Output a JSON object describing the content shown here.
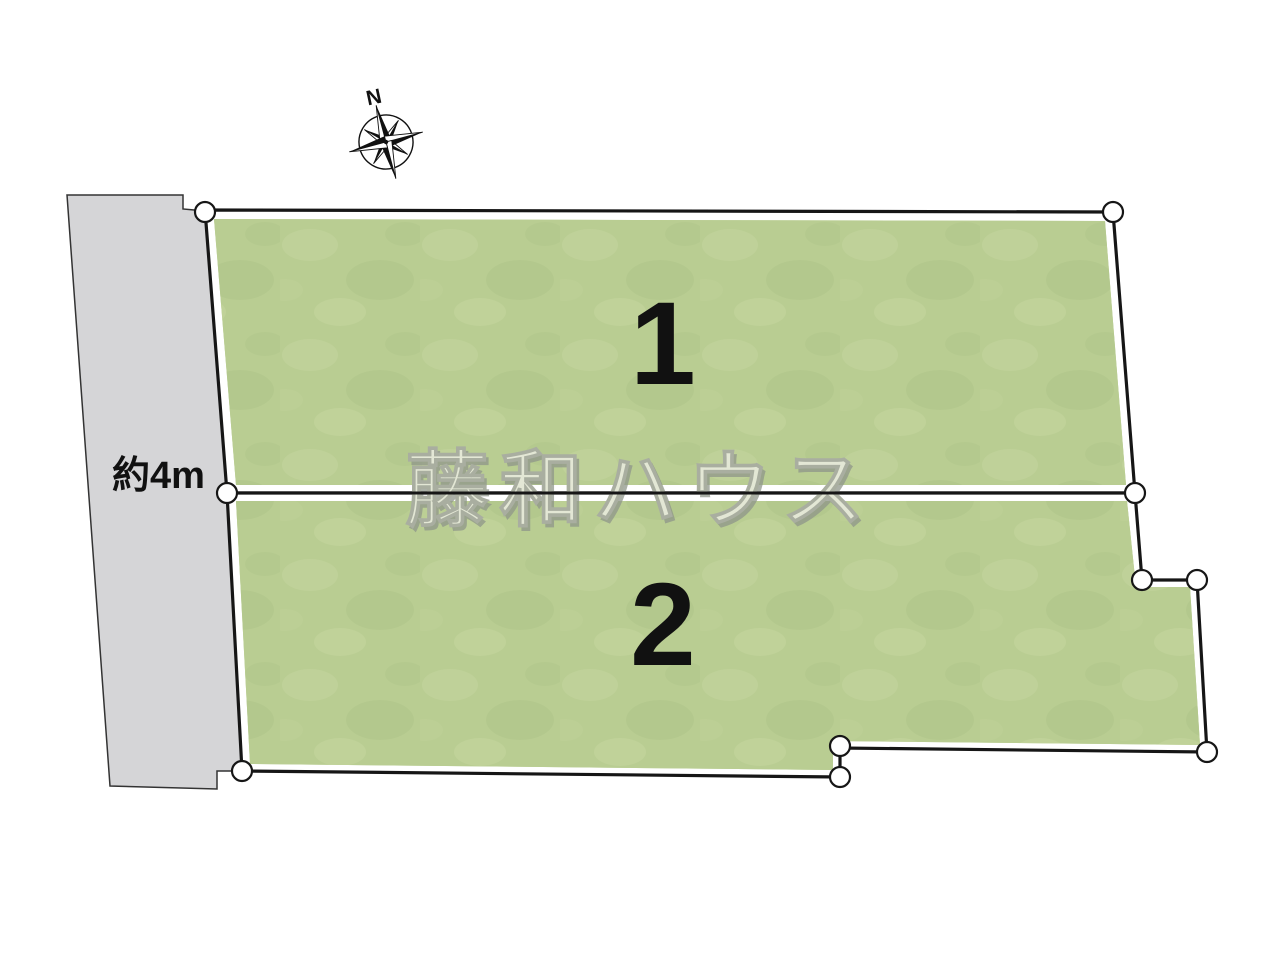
{
  "compass": {
    "label": "N"
  },
  "road": {
    "width_label": "約4m"
  },
  "watermark": {
    "text": "藤和ハウス"
  },
  "plots": [
    {
      "label": "1"
    },
    {
      "label": "2"
    }
  ],
  "diagram": {
    "canvas": {
      "width": 1280,
      "height": 960
    },
    "colors": {
      "plot_fill": "#b9cd92",
      "plot_inset": "#ffffff",
      "outline": "#161616",
      "road_fill": "#d5d5d7",
      "road_stroke": "#333333",
      "vertex_fill": "#ffffff",
      "background": "#ffffff"
    },
    "road": {
      "points": "67,195 183,195 183,209 205,211 227,493 242,771 217,771 217,789 110,786"
    },
    "parcels": [
      {
        "id": "1",
        "outer": "205,210 1113,212 1135,493 227,493",
        "inner": "214,219 1105,221 1126,485 236,485"
      },
      {
        "id": "2",
        "outer": "227,493 1135,493 1142,580 1197,580 1207,752 840,748 840,777 242,771",
        "inner": "236,501 1127,501 1136,587 1190,587 1200,745 833,741 833,770 250,764"
      }
    ],
    "divider": {
      "x1": 227,
      "y1": 493,
      "x2": 1135,
      "y2": 493
    },
    "vertices": [
      [
        205,
        212
      ],
      [
        1113,
        212
      ],
      [
        1135,
        493
      ],
      [
        227,
        493
      ],
      [
        1142,
        580
      ],
      [
        1197,
        580
      ],
      [
        1207,
        752
      ],
      [
        840,
        746
      ],
      [
        840,
        777
      ],
      [
        242,
        771
      ]
    ],
    "vertex_radius": 10
  }
}
